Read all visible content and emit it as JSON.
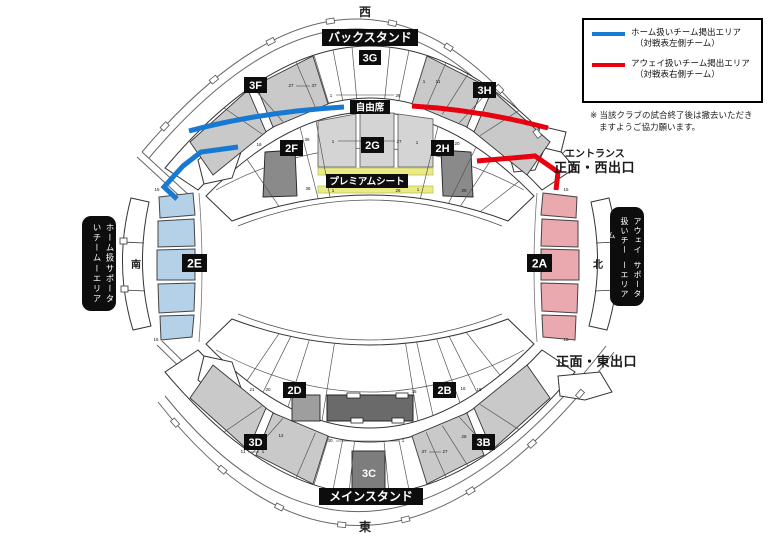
{
  "compass": {
    "west": "西",
    "east": "東",
    "south": "南",
    "north": "北"
  },
  "stands": {
    "back": "バックスタンド",
    "main": "メインスタンド"
  },
  "areas": {
    "free_seating": "自由席",
    "premium": "プレミアムシート"
  },
  "sections": {
    "s3g": "3G",
    "s3f": "3F",
    "s3h": "3H",
    "s2f": "2F",
    "s2g": "2G",
    "s2h": "2H",
    "s2e": "2E",
    "s2a": "2A",
    "s2d": "2D",
    "s2b": "2B",
    "s3d": "3D",
    "s3b": "3B",
    "s3c": "3C"
  },
  "supporters": {
    "home": {
      "line1": "ホーム扱いチーム",
      "line2": "サポーターエリア"
    },
    "away": {
      "line1": "アウェイ扱いチーム",
      "line2": "サポーターエリア"
    }
  },
  "legend": {
    "home": {
      "label": "ホーム扱いチーム掲出エリア",
      "sub": "（対戦表左側チーム）",
      "color": "#1879d2"
    },
    "away": {
      "label": "アウェイ扱いチーム掲出エリア",
      "sub": "（対戦表右側チーム）",
      "color": "#e8000f"
    }
  },
  "note": {
    "line1": "※ 当該クラブの試合終了後は撤去いただき",
    "line2": "ますようご協力願います。"
  },
  "exits": {
    "entrance": "エントランス",
    "west": "正面・西出口",
    "east": "正面・東出口"
  },
  "colors": {
    "home_area": "#b5d1e8",
    "away_area": "#e9a9af",
    "premium_yellow": "#ebeb84",
    "tier_gray": "#c9c9c9",
    "col_gray": "#d4d4d4",
    "dark_gray": "#6a6a6a",
    "mid_gray": "#8a8a8a",
    "light_box_gray": "#9e9e9e",
    "home_line": "#1879d2",
    "away_line": "#e8000f"
  },
  "ticks": [
    [
      291,
      87,
      "27"
    ],
    [
      314,
      87,
      "37"
    ],
    [
      424,
      83,
      "1"
    ],
    [
      438,
      83,
      "11"
    ],
    [
      331,
      97,
      "1"
    ],
    [
      398,
      97,
      "26"
    ],
    [
      333,
      143,
      "1"
    ],
    [
      399,
      143,
      "27"
    ],
    [
      307,
      141,
      "36"
    ],
    [
      259,
      146,
      "16"
    ],
    [
      417,
      144,
      "1"
    ],
    [
      457,
      145,
      "20"
    ],
    [
      333,
      192,
      "1"
    ],
    [
      398,
      192,
      "26"
    ],
    [
      308,
      190,
      "36"
    ],
    [
      418,
      191,
      "1"
    ],
    [
      464,
      192,
      "20"
    ],
    [
      157,
      191,
      "15"
    ],
    [
      156,
      341,
      "15"
    ],
    [
      566,
      191,
      "15"
    ],
    [
      566,
      341,
      "15"
    ],
    [
      330,
      442,
      "30"
    ],
    [
      403,
      442,
      "1"
    ],
    [
      243,
      453,
      "11"
    ],
    [
      263,
      453,
      "1"
    ],
    [
      424,
      453,
      "37"
    ],
    [
      445,
      453,
      "27"
    ],
    [
      281,
      437,
      "12"
    ],
    [
      464,
      438,
      "28"
    ],
    [
      252,
      391,
      "21"
    ],
    [
      268,
      391,
      "20"
    ],
    [
      414,
      393,
      "35"
    ],
    [
      463,
      390,
      "16"
    ],
    [
      479,
      391,
      "15"
    ]
  ]
}
